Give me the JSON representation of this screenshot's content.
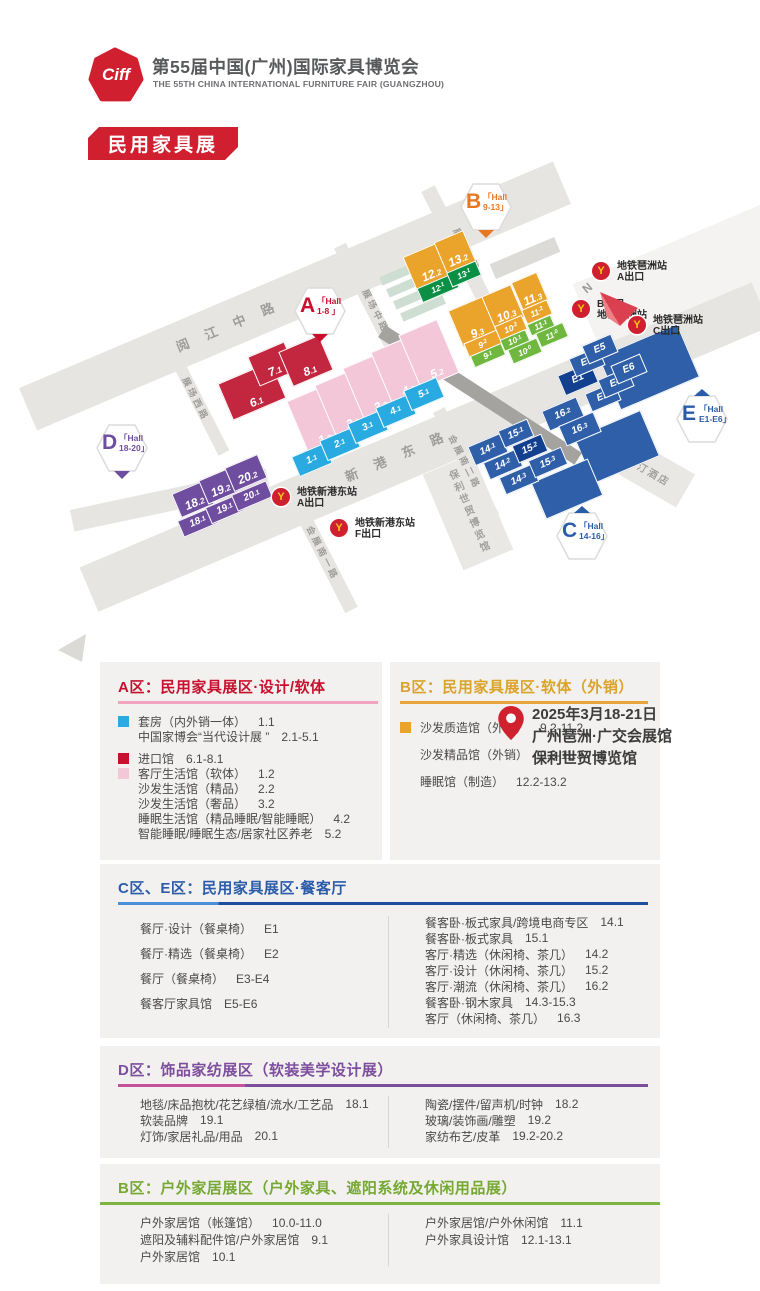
{
  "header": {
    "logo_text": "Ciff",
    "title": "第55届中国(广州)国际家具博览会",
    "subtitle": "THE 55TH CHINA INTERNATIONAL FURNITURE FAIR (GUANGZHOU)",
    "banner": "民用家具展",
    "brand_red": "#d01f2f"
  },
  "map": {
    "compass_n": "N",
    "venue": {
      "dates": "2025年3月18-21日",
      "venue1": "广州琶洲·广交会展馆",
      "venue2": "保利世贸博览馆"
    },
    "roads": [
      [
        295,
        296,
        580,
        46,
        -23
      ],
      [
        425,
        447,
        730,
        48,
        -23
      ],
      [
        462,
        255,
        150,
        15,
        63
      ],
      [
        374,
        312,
        150,
        13,
        63
      ],
      [
        199,
        404,
        110,
        12,
        63
      ],
      [
        322,
        552,
        130,
        14,
        63
      ],
      [
        466,
        463,
        120,
        13,
        63
      ],
      [
        170,
        500,
        200,
        22,
        -12
      ]
    ],
    "road_labels": [
      [
        "阅 江 中 路",
        228,
        325,
        -23,
        13,
        7
      ],
      [
        "新 港 东 路",
        397,
        455,
        -23,
        13,
        7
      ],
      [
        "展场东路",
        467,
        250,
        63,
        9,
        3
      ],
      [
        "展场中路",
        376,
        311,
        63,
        9,
        3
      ],
      [
        "展场西路",
        196,
        399,
        63,
        9,
        3
      ],
      [
        "会展南一路",
        323,
        553,
        63,
        9,
        3
      ],
      [
        "会展南二路",
        465,
        462,
        63,
        9,
        3
      ]
    ],
    "buildings": [
      [
        "威斯汀酒店",
        644,
        467,
        96,
        38,
        30,
        ""
      ],
      [
        "保利世贸博览馆",
        468,
        512,
        54,
        104,
        -23,
        "v"
      ]
    ],
    "shapes": [
      [
        648,
        366,
        84,
        56,
        "blue",
        -23
      ],
      [
        616,
        446,
        70,
        48,
        "blue",
        -23
      ],
      [
        566,
        488,
        60,
        38,
        "blue",
        -23
      ],
      [
        402,
        272,
        46,
        9,
        "teal",
        -23
      ],
      [
        409,
        284,
        46,
        9,
        "teal",
        -23
      ],
      [
        416,
        296,
        46,
        9,
        "teal",
        -23
      ],
      [
        423,
        308,
        46,
        9,
        "teal",
        -23
      ],
      [
        480,
        395,
        234,
        14,
        "walk",
        33
      ],
      [
        525,
        258,
        70,
        16,
        "road",
        -23
      ]
    ],
    "halls": [
      [
        "6.1",
        252,
        391,
        58,
        40,
        "red"
      ],
      [
        "7.1",
        272,
        364,
        40,
        32,
        "red"
      ],
      [
        "8.1",
        306,
        361,
        44,
        38,
        "red"
      ],
      [
        "1.2",
        317,
        420,
        42,
        58,
        "pink"
      ],
      [
        "2.2",
        345,
        404,
        42,
        58,
        "pink"
      ],
      [
        "3.2",
        373,
        387,
        42,
        58,
        "pink"
      ],
      [
        "4.2",
        401,
        371,
        42,
        58,
        "pink"
      ],
      [
        "5.2",
        429,
        354,
        42,
        58,
        "pink"
      ],
      [
        "1.1",
        311,
        459,
        34,
        20,
        "cyan"
      ],
      [
        "2.1",
        339,
        443,
        34,
        20,
        "cyan"
      ],
      [
        "3.1",
        367,
        426,
        34,
        20,
        "cyan"
      ],
      [
        "4.1",
        395,
        410,
        34,
        20,
        "cyan"
      ],
      [
        "5.1",
        423,
        393,
        34,
        20,
        "cyan"
      ],
      [
        "12.2",
        428,
        266,
        40,
        36,
        "yellow"
      ],
      [
        "13.2",
        455,
        252,
        32,
        34,
        "yellow"
      ],
      [
        "12.1",
        437,
        287,
        38,
        14,
        "dgreen"
      ],
      [
        "13.1",
        463,
        273,
        30,
        14,
        "dgreen"
      ],
      [
        "9.3",
        473,
        322,
        38,
        40,
        "yellow"
      ],
      [
        "10.3",
        503,
        307,
        32,
        36,
        "yellow"
      ],
      [
        "11.3",
        530,
        292,
        28,
        32,
        "yellow"
      ],
      [
        "9.2",
        482,
        343,
        34,
        14,
        "yellow"
      ],
      [
        "10.2",
        510,
        327,
        28,
        14,
        "yellow"
      ],
      [
        "11.2",
        536,
        311,
        26,
        14,
        "yellow"
      ],
      [
        "9.1",
        487,
        354,
        32,
        11,
        "green"
      ],
      [
        "10.1",
        514,
        339,
        26,
        11,
        "green"
      ],
      [
        "11.1",
        540,
        324,
        24,
        11,
        "green"
      ],
      [
        "10.0",
        524,
        350,
        30,
        14,
        "green"
      ],
      [
        "11.0",
        551,
        334,
        28,
        14,
        "green"
      ],
      [
        "E1",
        577,
        378,
        34,
        20,
        "navy"
      ],
      [
        "E3",
        586,
        361,
        30,
        18,
        "blue"
      ],
      [
        "E5",
        599,
        348,
        30,
        18,
        "blue"
      ],
      [
        "E2",
        602,
        396,
        30,
        18,
        "blue"
      ],
      [
        "E4",
        615,
        382,
        30,
        18,
        "blue"
      ],
      [
        "E6",
        628,
        368,
        30,
        18,
        "blue"
      ],
      [
        "16.2",
        562,
        413,
        36,
        20,
        "blue"
      ],
      [
        "16.3",
        579,
        428,
        36,
        20,
        "blue"
      ],
      [
        "14.1",
        487,
        448,
        34,
        19,
        "blue"
      ],
      [
        "15.1",
        515,
        432,
        30,
        17,
        "blue"
      ],
      [
        "14.2",
        502,
        463,
        34,
        17,
        "blue"
      ],
      [
        "15.2",
        529,
        447,
        30,
        17,
        "navy"
      ],
      [
        "14.3",
        518,
        478,
        34,
        17,
        "blue"
      ],
      [
        "15.3",
        547,
        461,
        34,
        17,
        "blue"
      ],
      [
        "18.2",
        193,
        499,
        36,
        26,
        "purple"
      ],
      [
        "19.2",
        219,
        486,
        34,
        26,
        "purple"
      ],
      [
        "20.2",
        246,
        473,
        36,
        26,
        "purple"
      ],
      [
        "18.1",
        197,
        521,
        36,
        16,
        "purple"
      ],
      [
        "19.1",
        224,
        508,
        34,
        16,
        "purple"
      ],
      [
        "20.1",
        251,
        495,
        36,
        16,
        "purple"
      ]
    ],
    "badges": [
      [
        "A",
        "「Hall",
        "1-8 」",
        "#c8102e",
        "bottom",
        320,
        311
      ],
      [
        "B",
        "「Hall",
        "9-13」",
        "#e87722",
        "bottom",
        486,
        207
      ],
      [
        "C",
        "「Hall",
        "14-16」",
        "#2b5caa",
        "top",
        582,
        536
      ],
      [
        "D",
        "「Hall",
        "18-20」",
        "#6f4d9f",
        "bottom",
        122,
        448
      ],
      [
        "E",
        "「Hall",
        "E1-E6」",
        "#2b5caa",
        "top",
        702,
        419
      ]
    ],
    "metros": [
      [
        [
          "地铁琶洲站",
          "A出口"
        ],
        601,
        271
      ],
      [
        [
          "B出口",
          "地铁琶洲站"
        ],
        581,
        309
      ],
      [
        [
          "地铁琶洲站",
          "C出口"
        ],
        637,
        325
      ],
      [
        [
          "地铁新港东站",
          "A出口"
        ],
        281,
        497
      ],
      [
        [
          "地铁新港东站",
          "F出口"
        ],
        339,
        528
      ]
    ]
  },
  "legend": {
    "a": {
      "title": "A区：民用家具展区·设计/软体",
      "color": "#c8102e",
      "ul": [
        "#f2a3c2"
      ],
      "items": [
        {
          "sw": "#29abe2",
          "n": "套房（内外销一体）",
          "c": "1.1"
        },
        {
          "n": "中国家博会“当代设计展 ”",
          "c": "2.1-5.1"
        },
        {
          "sw": "#c8102e",
          "n": "进口馆",
          "c": "6.1-8.1",
          "gap": true
        },
        {
          "sw": "#f3c6d8",
          "n": "客厅生活馆（软体）",
          "c": "1.2"
        },
        {
          "n": "沙发生活馆（精品）",
          "c": "2.2"
        },
        {
          "n": "沙发生活馆（奢品）",
          "c": "3.2"
        },
        {
          "n": "睡眠生活馆（精品睡眠/智能睡眠）",
          "c": "4.2"
        },
        {
          "n": "智能睡眠/睡眠生态/居家社区养老",
          "c": "5.2"
        }
      ]
    },
    "b": {
      "title": "B区：民用家具展区·软体（外销）",
      "color": "#dba32a",
      "ul": [
        "#e8a33d"
      ],
      "items": [
        {
          "sw": "#eaa42c",
          "n": "沙发质造馆（外销）",
          "c": "9.2-11.2"
        },
        {
          "n": "沙发精品馆（外销）",
          "c": "9.3-11.3"
        },
        {
          "n": "睡眠馆（制造）",
          "c": "12.2-13.2"
        }
      ]
    },
    "ce": {
      "title": "C区、E区：民用家具展区·餐客厅",
      "color": "#2b5caa",
      "ul": [
        "#4a90d9",
        "#1d4f9e",
        19
      ],
      "left": [
        {
          "n": "餐厅·设计（餐桌椅）",
          "c": "E1"
        },
        {
          "n": "餐厅·精选（餐桌椅）",
          "c": "E2"
        },
        {
          "n": "餐厅（餐桌椅）",
          "c": "E3-E4"
        },
        {
          "n": "餐客厅家具馆",
          "c": "E5-E6"
        }
      ],
      "right": [
        {
          "n": "餐客卧·板式家具/跨境电商专区",
          "c": "14.1"
        },
        {
          "n": "餐客卧·板式家具",
          "c": "15.1"
        },
        {
          "n": "客厅·精选（休闲椅、茶几）",
          "c": "14.2"
        },
        {
          "n": "客厅·设计（休闲椅、茶几）",
          "c": "15.2"
        },
        {
          "n": "客厅·潮流（休闲椅、茶几）",
          "c": "16.2"
        },
        {
          "n": "餐客卧·钢木家具",
          "c": "14.3-15.3"
        },
        {
          "n": "客厅（休闲椅、茶几）",
          "c": "16.3"
        }
      ]
    },
    "d": {
      "title": "D区：饰品家纺展区（软装美学设计展）",
      "color": "#7d4e9e",
      "ul": [
        "#c5519b",
        "#7d4e9e",
        24
      ],
      "left": [
        {
          "n": "地毯/床品抱枕/花艺绿植/流水/工艺品",
          "c": "18.1"
        },
        {
          "n": "软装品牌",
          "c": "19.1"
        },
        {
          "n": "灯饰/家居礼品/用品",
          "c": "20.1"
        }
      ],
      "right": [
        {
          "n": "陶瓷/摆件/留声机/时钟",
          "c": "18.2"
        },
        {
          "n": "玻璃/装饰画/雕塑",
          "c": "19.2"
        },
        {
          "n": "家纺布艺/皮革",
          "c": "19.2-20.2"
        }
      ]
    },
    "outdoor": {
      "title": "B区：户外家居展区（户外家具、遮阳系统及休闲用品展）",
      "color": "#76a832",
      "ul": [
        "#7cb342"
      ],
      "left": [
        {
          "n": "户外家居馆（帐篷馆）",
          "c": "10.0-11.0"
        },
        {
          "n": "遮阳及辅料配件馆/户外家居馆",
          "c": "9.1"
        },
        {
          "n": "户外家居馆",
          "c": "10.1"
        }
      ],
      "right": [
        {
          "n": "户外家居馆/户外休闲馆",
          "c": "11.1"
        },
        {
          "n": "户外家具设计馆",
          "c": "12.1-13.1"
        }
      ]
    }
  }
}
